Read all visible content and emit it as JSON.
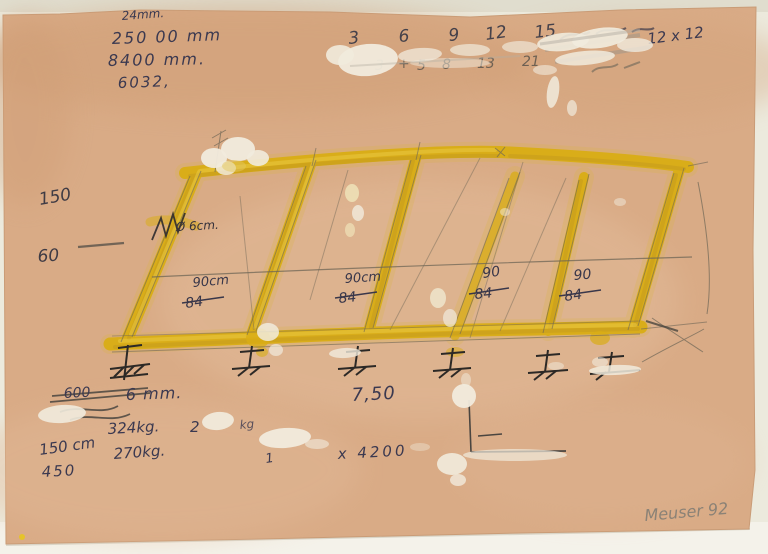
{
  "artwork": {
    "medium": "mixed-media-sketch",
    "colors": {
      "paper": "#d9ab86",
      "mat": "#eceadd",
      "yellow": "#d9ad15",
      "ink": "#3b3950",
      "pencil": "#6e6656",
      "gouache": "#f1ebdd"
    },
    "top_left_notes": {
      "l1": "24mm.",
      "l2": "250 00 mm",
      "l3": "8400 mm.",
      "l4": "6032,"
    },
    "sequence_row1": {
      "n1": "3",
      "n2": "6",
      "n3": "9",
      "n4": "12",
      "n5": "15"
    },
    "sequence_row2": {
      "n1": "3",
      "n2": "+",
      "n3": "5",
      "n4": "8",
      "n5": "13",
      "n6": "21"
    },
    "top_right_note": "12 x 12",
    "left_notes": {
      "height": "150",
      "width": "60"
    },
    "bar_width_note": "Ø 6cm.",
    "span_labels": {
      "c1": {
        "value": "90cm",
        "old": "84"
      },
      "c2": {
        "value": "90cm",
        "old": "84"
      },
      "c3": {
        "value": "90",
        "old": "84"
      },
      "c4": {
        "value": "90",
        "old": "84"
      }
    },
    "bottom_left": {
      "struck": "600",
      "thickness": "6 mm.",
      "weight_a": "324kg.",
      "qty": "2",
      "qty_unit": "kg",
      "length": "150 cm",
      "alt_length": "450",
      "weight_b": "270kg."
    },
    "bottom_mid": {
      "ratio": "7,50",
      "hidden_prefix": "1",
      "dimensions": "x 4200"
    },
    "signature": "Meuser 92"
  }
}
